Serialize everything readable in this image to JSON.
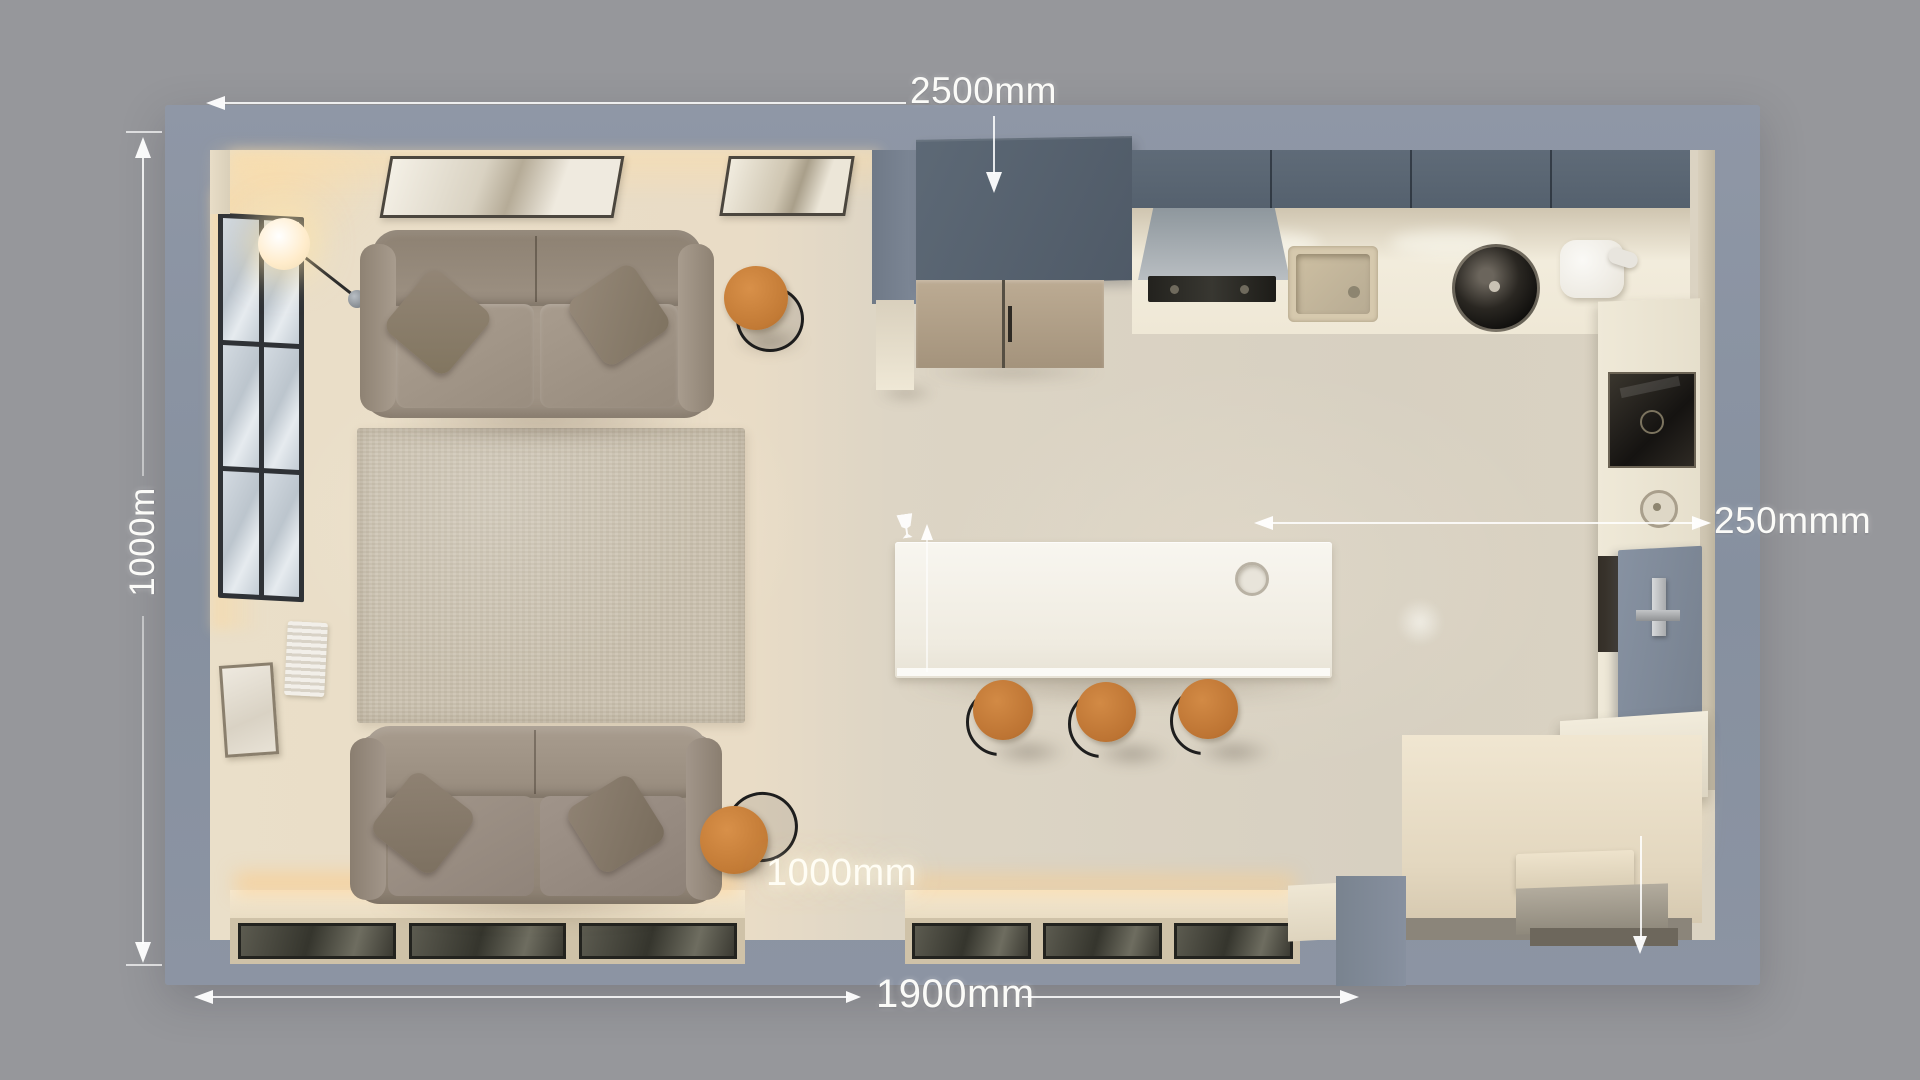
{
  "scene": {
    "type": "apartment-floor-plan-render",
    "rooms": [
      "living-room",
      "kitchen"
    ],
    "furniture": [
      "sofa-upper",
      "sofa-lower",
      "area-rug",
      "side-table-upper",
      "side-table-lower",
      "floor-lamp",
      "wall-art-large",
      "wall-art-small",
      "window-left",
      "radiator",
      "leaning-picture-frame",
      "tall-cabinet",
      "fridge-cabinet",
      "upper-cabinets",
      "range-hood",
      "cooktop",
      "counter-sink",
      "stock-pot",
      "stand-mixer",
      "oven",
      "kitchen-island",
      "island-sink",
      "bar-stool-1",
      "bar-stool-2",
      "bar-stool-3",
      "right-counter",
      "gray-base-cabinet",
      "corner-step",
      "floor-glazing"
    ]
  },
  "palette": {
    "background": "#96979b",
    "wall": "#8b93a2",
    "living_floor": "#eadfc9",
    "kitchen_floor": "#d7d0c1",
    "rug": "#cbc2b0",
    "sofa": "#9f9385",
    "wood_accent": "#c9813e",
    "dark_cabinet": "#57616e",
    "counter": "#f0ead9",
    "glass": "#3b3a32",
    "annotation": "#ffffff"
  },
  "annotations": {
    "top_width": {
      "label": "2500mm"
    },
    "left_height": {
      "label": "1000m"
    },
    "right_clearance": {
      "label": "250mmm"
    },
    "island_walkway": {
      "label": "1000mm"
    },
    "bottom_width": {
      "label": "1900mm"
    }
  }
}
